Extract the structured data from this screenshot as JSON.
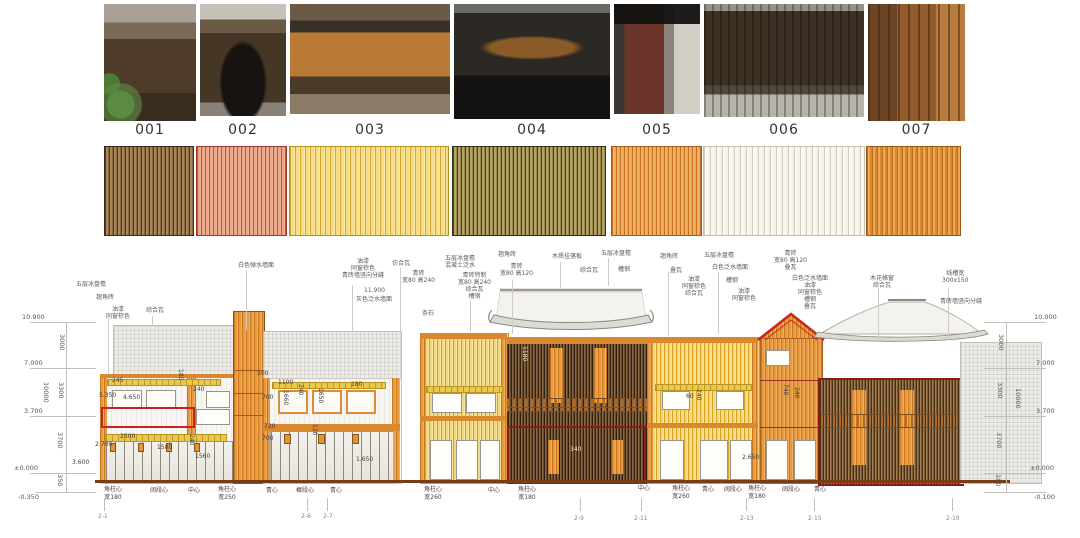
{
  "page": {
    "background": "#ffffff"
  },
  "photos": {
    "labels": [
      "001",
      "002",
      "003",
      "004",
      "005",
      "006",
      "007"
    ]
  },
  "swatches": {
    "colors": [
      {
        "id": "001",
        "base": "#a8865c",
        "stripe": "#503a26"
      },
      {
        "id": "002",
        "base": "#f0a488",
        "stripe": "#c85040"
      },
      {
        "id": "003",
        "base": "#f4dc88",
        "stripe": "#d8a830"
      },
      {
        "id": "004",
        "base": "#b4a468",
        "stripe": "#4a3c1e"
      },
      {
        "id": "005",
        "base": "#f0b468",
        "stripe": "#c87020"
      },
      {
        "id": "006",
        "base": "#faf8f2",
        "stripe": "#d0ccc0"
      },
      {
        "id": "007",
        "base": "#eca855",
        "stripe": "#c06c1c"
      }
    ]
  },
  "elevation": {
    "highlight_color": "#cf1f1f",
    "left_axis": {
      "levels": [
        "10.900",
        "7.000",
        "3.700",
        "±0.000",
        "-0.350"
      ],
      "segments": [
        "3000",
        "3300",
        "3700",
        "350"
      ],
      "total": "10000"
    },
    "right_axis": {
      "levels": [
        "10.000",
        "7.000",
        "3.700",
        "±0.000",
        "-0.100"
      ],
      "segments": [
        "3000",
        "3300",
        "3700",
        "100"
      ],
      "total": "10000"
    },
    "annotations": [
      "五层冰盘檐",
      "翘角砖",
      "油漆\n同窗棕色",
      "综合瓦",
      "白色弹水墙面",
      "油漆\n同窗棕色\n青砖墙竖向分缝",
      "11.900",
      "灰色泛水墙面",
      "条石",
      "仿合瓦",
      "青砖\n宽80 高240",
      "五层冰盘檐\n混凝土泛水",
      "青砖特制\n宽80 高240\n综合瓦\n槽钢",
      "翘角砖",
      "青砖\n宽80 高120",
      "木质挂落板",
      "综合瓦",
      "五层冰盘檐",
      "槽钢",
      "翘角砖",
      "叠瓦",
      "油漆\n同窗棕色\n综合瓦",
      "五层冰盘檐",
      "白色泛水墙面",
      "槽钢",
      "油漆\n同窗棕色",
      "青砖\n宽80 高120\n叠瓦",
      "白色泛水墙面\n油漆\n同窗棕色\n槽钢\n叠瓦",
      "木花格窗\n综合瓦",
      "线槽宽\n300x150",
      "青砖墙竖向分缝"
    ],
    "bottom_labels": [
      "角柱心\n宽180",
      "阔段心",
      "中心",
      "角柱心\n宽250",
      "青心",
      "樨段心",
      "青心",
      "角柱心\n宽260",
      "中心",
      "角柱心\n宽180",
      "中心",
      "角柱心\n宽260",
      "青心",
      "阔段心",
      "角柱心\n宽180",
      "阔段心",
      "青心"
    ],
    "grid_labels": [
      "2-1",
      "2-6",
      "2-7",
      "2-9",
      "2-11",
      "2-13",
      "2-15",
      "2-19"
    ],
    "dims": [
      "245",
      "180",
      "240",
      "5.350",
      "4.650",
      "2500",
      "1500",
      "240",
      "1560",
      "2.700",
      "500",
      "1100",
      "1660",
      "240",
      "1650",
      "180",
      "700",
      "720",
      "120",
      "700",
      "1.650",
      "3.600",
      "1180",
      "340",
      "240",
      "60",
      "2.650",
      "740",
      "240"
    ]
  }
}
